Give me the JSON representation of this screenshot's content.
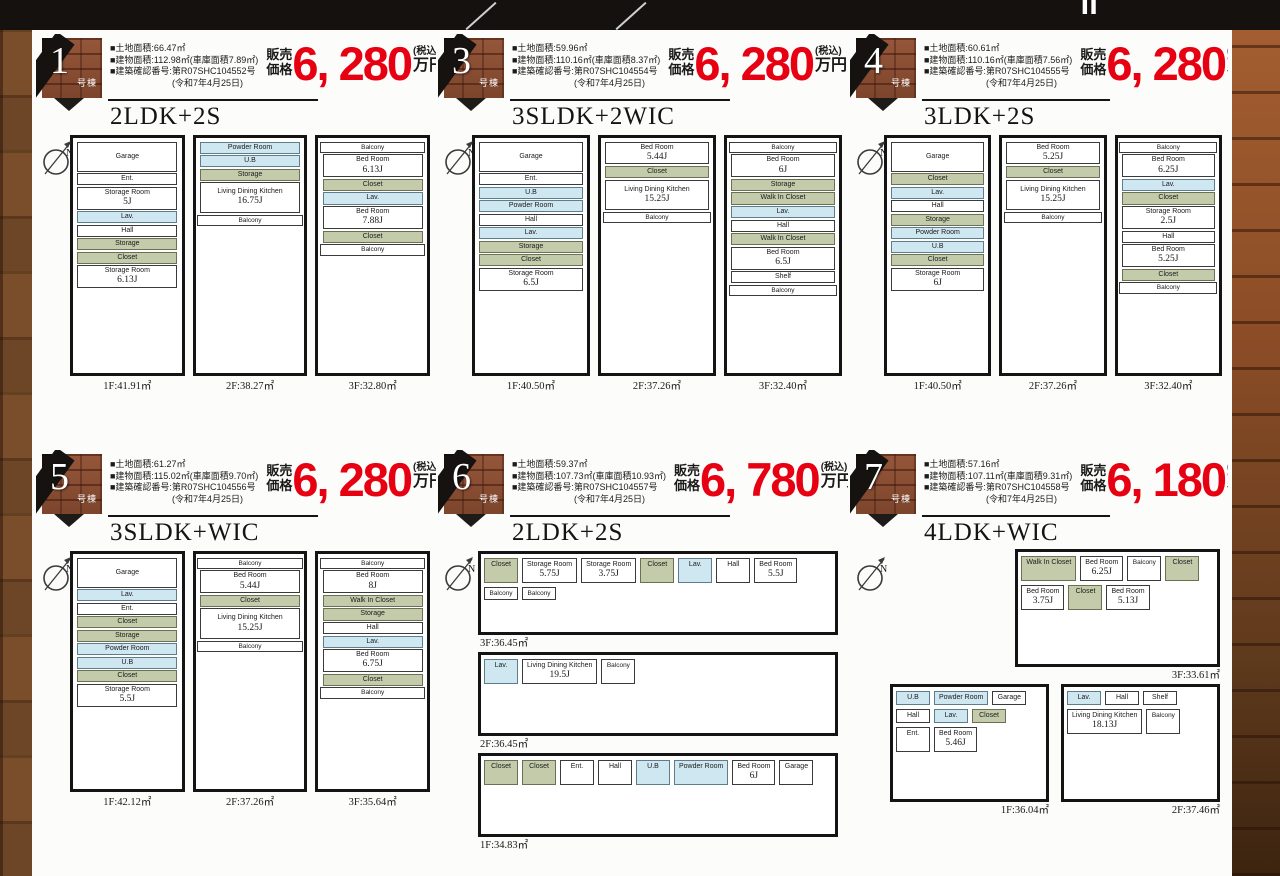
{
  "header": {
    "title_fragment": "Ⅱ"
  },
  "labels": {
    "unit_label": "号棟",
    "price_prefix_top": "販売",
    "price_prefix_bottom": "価格",
    "price_suffix_top": "(税込)",
    "price_suffix_bottom": "万円"
  },
  "properties": [
    {
      "no": "1",
      "plan_type": "2LDK+2S",
      "price": "6, 280",
      "plan_layout": "tall",
      "specs": [
        "■土地面積:66.47㎡",
        "■建物面積:112.98㎡(車庫面積7.89㎡)",
        "■建築確認番号:第R07SHC104552号",
        "(令和7年4月25日)"
      ],
      "floors": [
        {
          "label": "1F:41.91㎡",
          "rooms": [
            {
              "t": "w",
              "n": "Garage"
            },
            {
              "t": "w",
              "n": "Ent."
            },
            {
              "t": "w",
              "n": "Storage Room",
              "s": "5J"
            },
            {
              "t": "b",
              "n": "Lav."
            },
            {
              "t": "w",
              "n": "Hall"
            },
            {
              "t": "g",
              "n": "Storage"
            },
            {
              "t": "g",
              "n": "Closet"
            },
            {
              "t": "w",
              "n": "Storage Room",
              "s": "6.13J"
            }
          ]
        },
        {
          "label": "2F:38.27㎡",
          "rooms": [
            {
              "t": "b",
              "n": "Powder Room"
            },
            {
              "t": "b",
              "n": "U.B"
            },
            {
              "t": "g",
              "n": "Storage"
            },
            {
              "t": "w",
              "n": "Living Dining Kitchen",
              "s": "16.75J"
            },
            {
              "t": "bal",
              "n": "Balcony"
            }
          ]
        },
        {
          "label": "3F:32.80㎡",
          "rooms": [
            {
              "t": "bal",
              "n": "Balcony"
            },
            {
              "t": "w",
              "n": "Bed Room",
              "s": "6.13J"
            },
            {
              "t": "g",
              "n": "Closet"
            },
            {
              "t": "b",
              "n": "Lav."
            },
            {
              "t": "w",
              "n": "Bed Room",
              "s": "7.88J"
            },
            {
              "t": "g",
              "n": "Closet"
            },
            {
              "t": "bal",
              "n": "Balcony"
            }
          ]
        }
      ]
    },
    {
      "no": "3",
      "plan_type": "3SLDK+2WIC",
      "price": "6, 280",
      "plan_layout": "tall",
      "specs": [
        "■土地面積:59.96㎡",
        "■建物面積:110.16㎡(車庫面積8.37㎡)",
        "■建築確認番号:第R07SHC104554号",
        "(令和7年4月25日)"
      ],
      "floors": [
        {
          "label": "1F:40.50㎡",
          "rooms": [
            {
              "t": "w",
              "n": "Garage"
            },
            {
              "t": "w",
              "n": "Ent."
            },
            {
              "t": "b",
              "n": "U.B"
            },
            {
              "t": "b",
              "n": "Powder Room"
            },
            {
              "t": "w",
              "n": "Hall"
            },
            {
              "t": "b",
              "n": "Lav."
            },
            {
              "t": "g",
              "n": "Storage"
            },
            {
              "t": "g",
              "n": "Closet"
            },
            {
              "t": "w",
              "n": "Storage Room",
              "s": "6.5J"
            }
          ]
        },
        {
          "label": "2F:37.26㎡",
          "rooms": [
            {
              "t": "w",
              "n": "Bed Room",
              "s": "5.44J"
            },
            {
              "t": "g",
              "n": "Closet"
            },
            {
              "t": "w",
              "n": "Living Dining Kitchen",
              "s": "15.25J"
            },
            {
              "t": "bal",
              "n": "Balcony"
            }
          ]
        },
        {
          "label": "3F:32.40㎡",
          "rooms": [
            {
              "t": "bal",
              "n": "Balcony"
            },
            {
              "t": "w",
              "n": "Bed Room",
              "s": "6J"
            },
            {
              "t": "g",
              "n": "Storage"
            },
            {
              "t": "g",
              "n": "Walk In Closet"
            },
            {
              "t": "b",
              "n": "Lav."
            },
            {
              "t": "w",
              "n": "Hall"
            },
            {
              "t": "g",
              "n": "Walk In Closet"
            },
            {
              "t": "w",
              "n": "Bed Room",
              "s": "6.5J"
            },
            {
              "t": "w",
              "n": "Shelf"
            },
            {
              "t": "bal",
              "n": "Balcony"
            }
          ]
        }
      ]
    },
    {
      "no": "4",
      "plan_type": "3LDK+2S",
      "price": "6, 280",
      "plan_layout": "tall",
      "specs": [
        "■土地面積:60.61㎡",
        "■建物面積:110.16㎡(車庫面積7.56㎡)",
        "■建築確認番号:第R07SHC104555号",
        "(令和7年4月25日)"
      ],
      "floors": [
        {
          "label": "1F:40.50㎡",
          "rooms": [
            {
              "t": "w",
              "n": "Garage"
            },
            {
              "t": "g",
              "n": "Closet"
            },
            {
              "t": "b",
              "n": "Lav."
            },
            {
              "t": "w",
              "n": "Hall"
            },
            {
              "t": "g",
              "n": "Storage"
            },
            {
              "t": "b",
              "n": "Powder Room"
            },
            {
              "t": "b",
              "n": "U.B"
            },
            {
              "t": "g",
              "n": "Closet"
            },
            {
              "t": "w",
              "n": "Storage Room",
              "s": "6J"
            }
          ]
        },
        {
          "label": "2F:37.26㎡",
          "rooms": [
            {
              "t": "w",
              "n": "Bed Room",
              "s": "5.25J"
            },
            {
              "t": "g",
              "n": "Closet"
            },
            {
              "t": "w",
              "n": "Living Dining Kitchen",
              "s": "15.25J"
            },
            {
              "t": "bal",
              "n": "Balcony"
            }
          ]
        },
        {
          "label": "3F:32.40㎡",
          "rooms": [
            {
              "t": "bal",
              "n": "Balcony"
            },
            {
              "t": "w",
              "n": "Bed Room",
              "s": "6.25J"
            },
            {
              "t": "b",
              "n": "Lav."
            },
            {
              "t": "g",
              "n": "Closet"
            },
            {
              "t": "w",
              "n": "Storage Room",
              "s": "2.5J"
            },
            {
              "t": "w",
              "n": "Hall"
            },
            {
              "t": "w",
              "n": "Bed Room",
              "s": "5.25J"
            },
            {
              "t": "g",
              "n": "Closet"
            },
            {
              "t": "bal",
              "n": "Balcony"
            }
          ]
        }
      ]
    },
    {
      "no": "5",
      "plan_type": "3SLDK+WIC",
      "price": "6, 280",
      "plan_layout": "tall",
      "specs": [
        "■土地面積:61.27㎡",
        "■建物面積:115.02㎡(車庫面積9.70㎡)",
        "■建築確認番号:第R07SHC104556号",
        "(令和7年4月25日)"
      ],
      "floors": [
        {
          "label": "1F:42.12㎡",
          "rooms": [
            {
              "t": "w",
              "n": "Garage"
            },
            {
              "t": "b",
              "n": "Lav."
            },
            {
              "t": "w",
              "n": "Ent."
            },
            {
              "t": "g",
              "n": "Closet"
            },
            {
              "t": "g",
              "n": "Storage"
            },
            {
              "t": "b",
              "n": "Powder Room"
            },
            {
              "t": "b",
              "n": "U.B"
            },
            {
              "t": "g",
              "n": "Closet"
            },
            {
              "t": "w",
              "n": "Storage Room",
              "s": "5.5J"
            }
          ]
        },
        {
          "label": "2F:37.26㎡",
          "rooms": [
            {
              "t": "bal",
              "n": "Balcony"
            },
            {
              "t": "w",
              "n": "Bed Room",
              "s": "5.44J"
            },
            {
              "t": "g",
              "n": "Closet"
            },
            {
              "t": "w",
              "n": "Living Dining Kitchen",
              "s": "15.25J"
            },
            {
              "t": "bal",
              "n": "Balcony"
            }
          ]
        },
        {
          "label": "3F:35.64㎡",
          "rooms": [
            {
              "t": "bal",
              "n": "Balcony"
            },
            {
              "t": "w",
              "n": "Bed Room",
              "s": "8J"
            },
            {
              "t": "g",
              "n": "Walk In Closet"
            },
            {
              "t": "g",
              "n": "Storage"
            },
            {
              "t": "w",
              "n": "Hall"
            },
            {
              "t": "b",
              "n": "Lav."
            },
            {
              "t": "w",
              "n": "Bed Room",
              "s": "6.75J"
            },
            {
              "t": "g",
              "n": "Closet"
            },
            {
              "t": "bal",
              "n": "Balcony"
            }
          ]
        }
      ]
    },
    {
      "no": "6",
      "plan_type": "2LDK+2S",
      "price": "6, 780",
      "plan_layout": "wide",
      "specs": [
        "■土地面積:59.37㎡",
        "■建物面積:107.73㎡(車庫面積10.93㎡)",
        "■建築確認番号:第R07SHC104557号",
        "(令和7年4月25日)"
      ],
      "floors": [
        {
          "label": "3F:36.45㎡",
          "rooms": [
            {
              "t": "g",
              "n": "Closet"
            },
            {
              "t": "w",
              "n": "Storage Room",
              "s": "5.75J"
            },
            {
              "t": "w",
              "n": "Storage Room",
              "s": "3.75J"
            },
            {
              "t": "g",
              "n": "Closet"
            },
            {
              "t": "b",
              "n": "Lav."
            },
            {
              "t": "w",
              "n": "Hall"
            },
            {
              "t": "w",
              "n": "Bed Room",
              "s": "5.5J"
            },
            {
              "t": "bal",
              "n": "Balcony"
            },
            {
              "t": "bal",
              "n": "Balcony"
            }
          ]
        },
        {
          "label": "2F:36.45㎡",
          "rooms": [
            {
              "t": "b",
              "n": "Lav."
            },
            {
              "t": "w",
              "n": "Living Dining Kitchen",
              "s": "19.5J"
            },
            {
              "t": "bal",
              "n": "Balcony"
            }
          ]
        },
        {
          "label": "1F:34.83㎡",
          "rooms": [
            {
              "t": "g",
              "n": "Closet"
            },
            {
              "t": "g",
              "n": "Closet"
            },
            {
              "t": "w",
              "n": "Ent."
            },
            {
              "t": "w",
              "n": "Hall"
            },
            {
              "t": "b",
              "n": "U.B"
            },
            {
              "t": "b",
              "n": "Powder Room"
            },
            {
              "t": "w",
              "n": "Bed Room",
              "s": "6J"
            },
            {
              "t": "w",
              "n": "Garage"
            }
          ]
        }
      ]
    },
    {
      "no": "7",
      "plan_type": "4LDK+WIC",
      "price": "6, 180",
      "plan_layout": "mixed",
      "specs": [
        "■土地面積:57.16㎡",
        "■建物面積:107.11㎡(車庫面積9.31㎡)",
        "■建築確認番号:第R07SHC104558号",
        "(令和7年4月25日)"
      ],
      "floors": [
        {
          "label": "3F:33.61㎡",
          "rooms": [
            {
              "t": "g",
              "n": "Walk In Closet"
            },
            {
              "t": "w",
              "n": "Bed Room",
              "s": "6.25J"
            },
            {
              "t": "bal",
              "n": "Balcony"
            },
            {
              "t": "g",
              "n": "Closet"
            },
            {
              "t": "w",
              "n": "Bed Room",
              "s": "3.75J"
            },
            {
              "t": "g",
              "n": "Closet"
            },
            {
              "t": "w",
              "n": "Bed Room",
              "s": "5.13J"
            }
          ]
        },
        {
          "label": "1F:36.04㎡",
          "rooms": [
            {
              "t": "b",
              "n": "U.B"
            },
            {
              "t": "b",
              "n": "Powder Room"
            },
            {
              "t": "w",
              "n": "Garage"
            },
            {
              "t": "w",
              "n": "Hall"
            },
            {
              "t": "b",
              "n": "Lav."
            },
            {
              "t": "g",
              "n": "Closet"
            },
            {
              "t": "w",
              "n": "Ent."
            },
            {
              "t": "w",
              "n": "Bed Room",
              "s": "5.46J"
            }
          ]
        },
        {
          "label": "2F:37.46㎡",
          "rooms": [
            {
              "t": "b",
              "n": "Lav."
            },
            {
              "t": "w",
              "n": "Hall"
            },
            {
              "t": "w",
              "n": "Shelf"
            },
            {
              "t": "w",
              "n": "Living Dining Kitchen",
              "s": "18.13J"
            },
            {
              "t": "bal",
              "n": "Balcony"
            }
          ]
        }
      ]
    }
  ]
}
